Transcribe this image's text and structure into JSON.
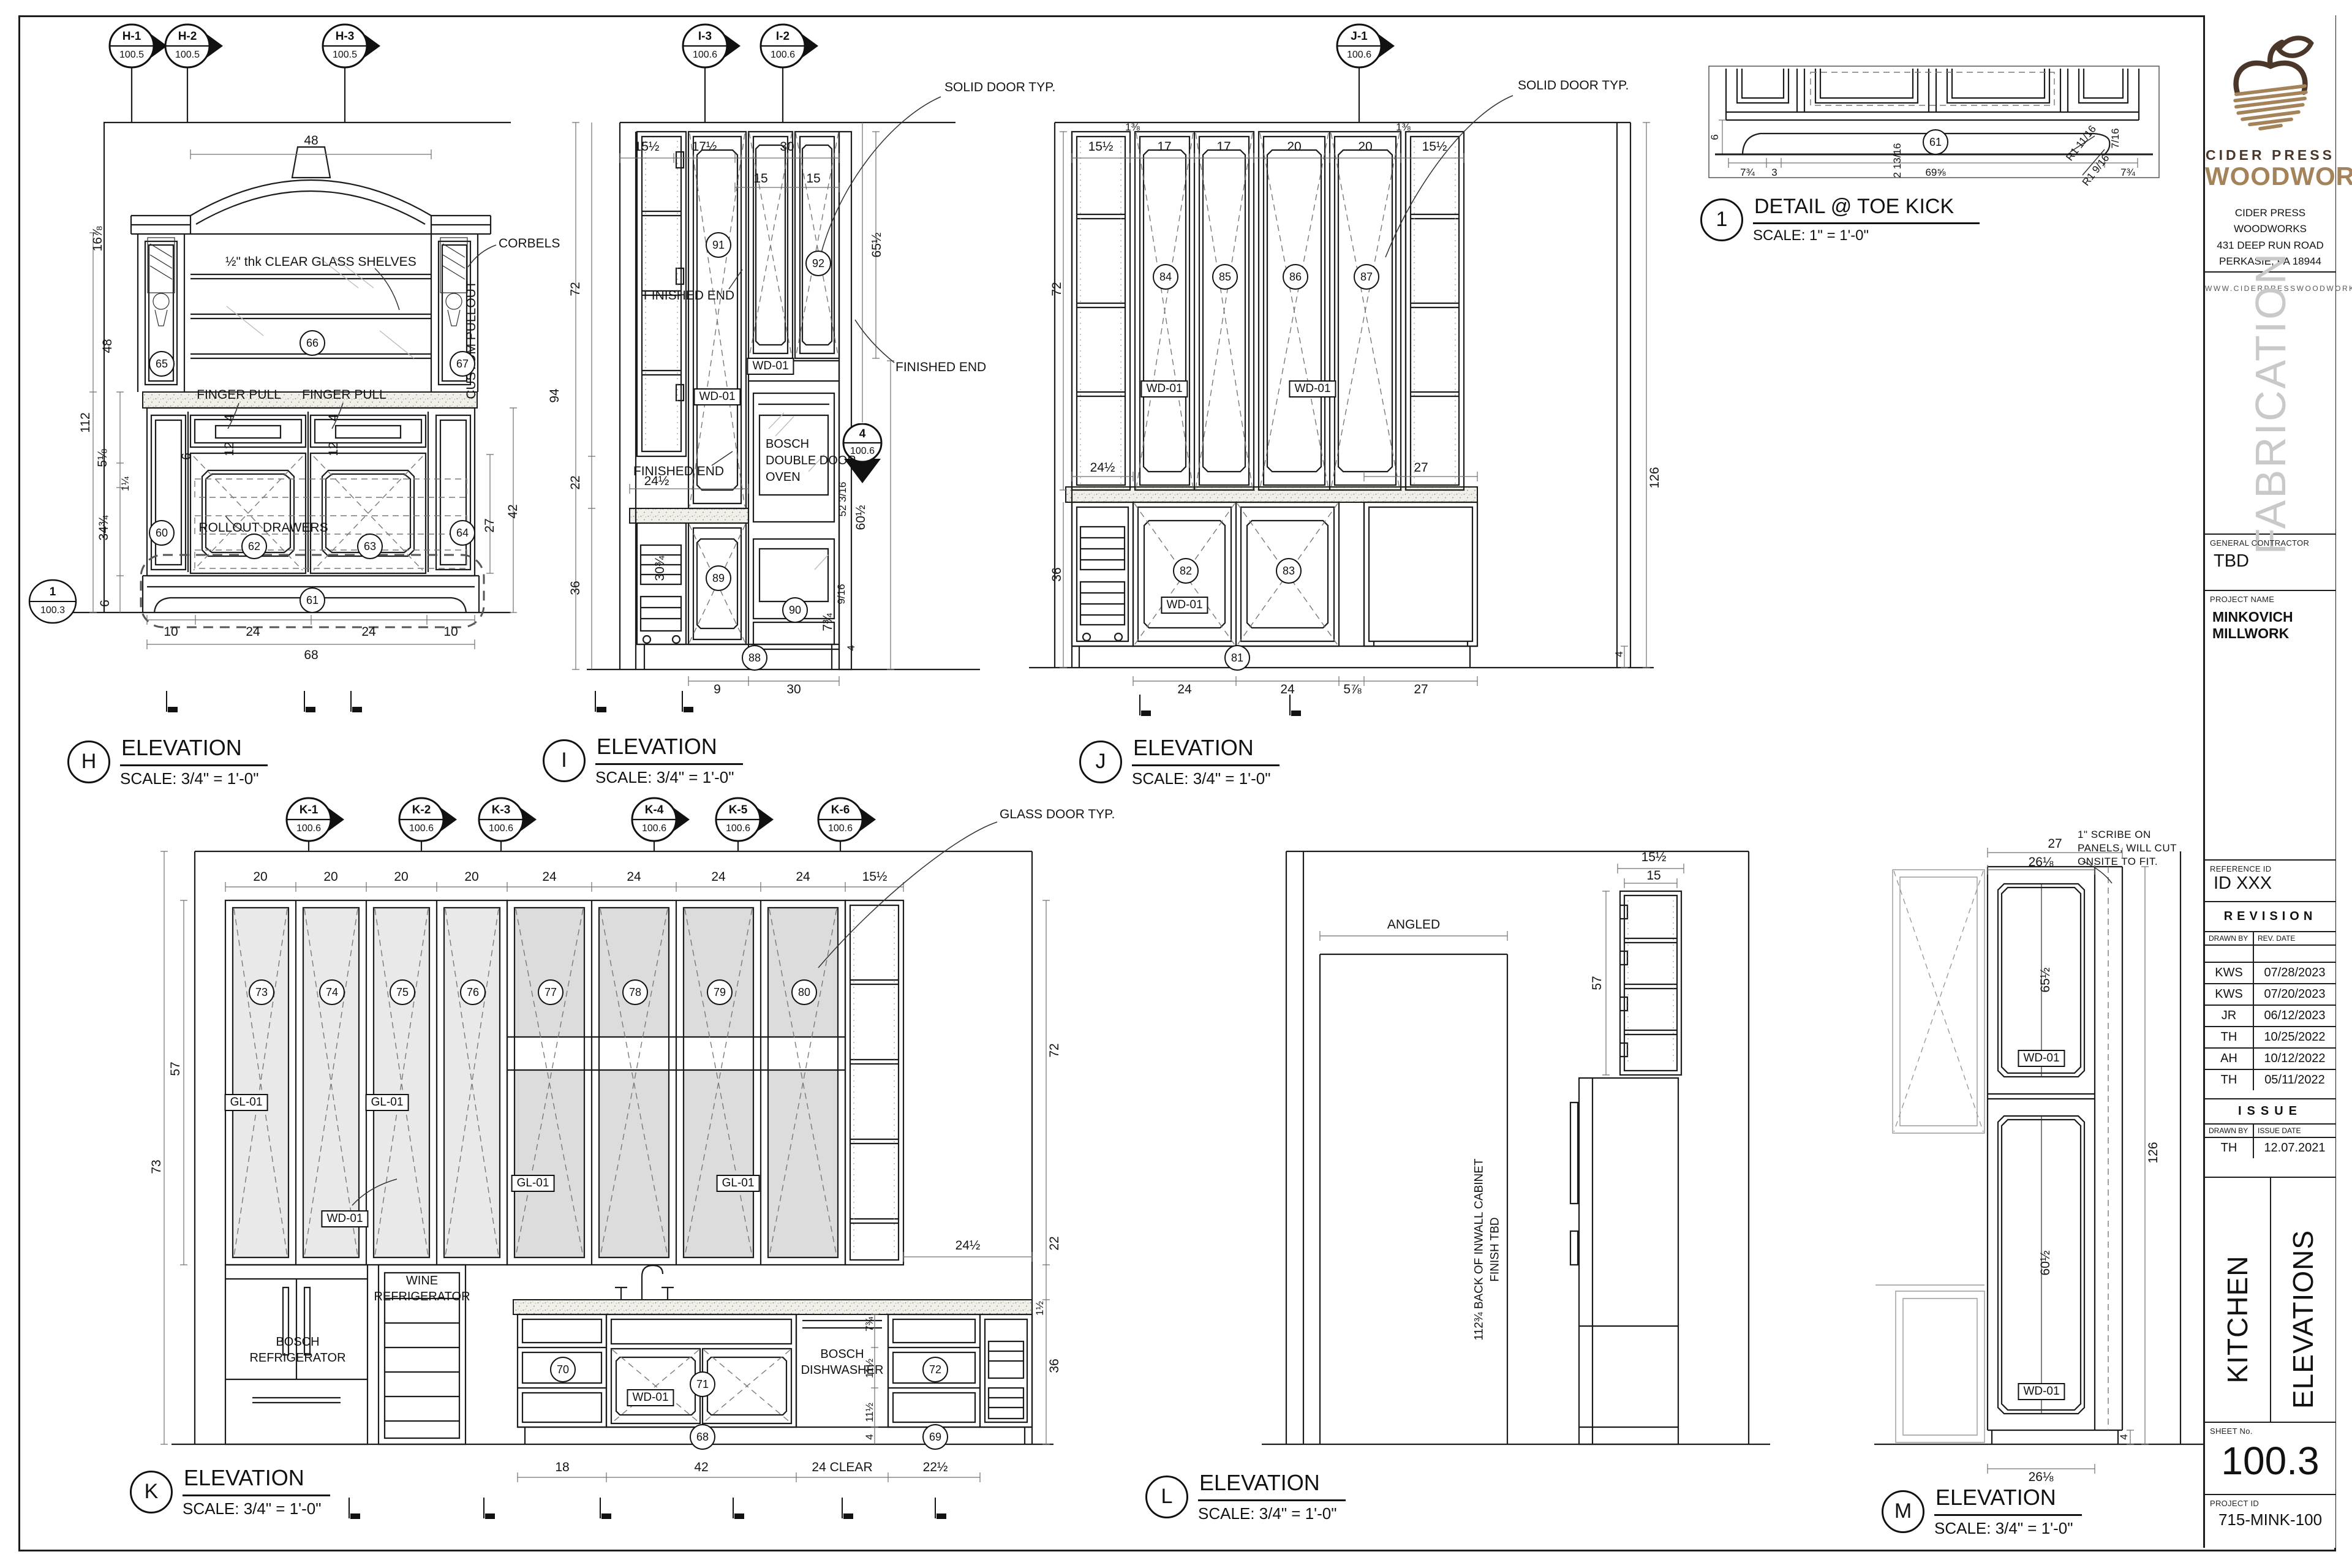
{
  "title_block": {
    "brand_line1": "CIDER PRESS",
    "brand_line2": "WOODWORKS",
    "address1": "CIDER PRESS WOODWORKS",
    "address2": "431 DEEP RUN ROAD",
    "address3": "PERKASIE, PA 18944",
    "website": "WWW.CIDERPRESSWOODWORKS.COM",
    "watermark": "FABRICATION",
    "gc_label": "GENERAL CONTRACTOR",
    "gc": "TBD",
    "pn_label": "PROJECT NAME",
    "pn": "MINKOVICH MILLWORK",
    "ref_label": "REFERENCE ID",
    "ref": "ID XXX",
    "revision_title": "REVISION",
    "col_drawn": "DRAWN BY",
    "col_revdate": "REV. DATE",
    "revisions": [
      {
        "by": "KWS",
        "date": "07/28/2023"
      },
      {
        "by": "KWS",
        "date": "07/20/2023"
      },
      {
        "by": "JR",
        "date": "06/12/2023"
      },
      {
        "by": "TH",
        "date": "10/25/2022"
      },
      {
        "by": "AH",
        "date": "10/12/2022"
      },
      {
        "by": "TH",
        "date": "05/11/2022"
      }
    ],
    "issue_title": "ISSUE",
    "col_issuedate": "ISSUE DATE",
    "issue_by": "TH",
    "issue_date": "12.07.2021",
    "name1": "KITCHEN",
    "name2": "ELEVATIONS",
    "sheetno_label": "SHEET No.",
    "sheetno": "100.3",
    "pid_label": "PROJECT ID",
    "pid": "715-MINK-100"
  },
  "detail": {
    "num": "1",
    "title": "DETAIL  @ TOE KICK",
    "scale": "SCALE: 1\" = 1'-0\"",
    "bubble": "61",
    "d6": "6",
    "d7a": "7¾",
    "d3": "3",
    "d213": "2 13/16",
    "d69": "69⅝",
    "r1": "R1 11/16",
    "r2": "R1 9/16",
    "d716": "7/16",
    "d7b": "7¾"
  },
  "elev_h": {
    "letter": "H",
    "title": "ELEVATION",
    "scale": "SCALE: 3/4\" = 1'-0\"",
    "markers": [
      {
        "id": "H-1",
        "sh": "100.5"
      },
      {
        "id": "H-2",
        "sh": "100.5"
      },
      {
        "id": "H-3",
        "sh": "100.5"
      }
    ],
    "ref_top": "1",
    "ref_bot": "100.3",
    "corbels": "CORBELS",
    "shelves": "½\" thk CLEAR GLASS SHELVES",
    "fp1": "FINGER PULL",
    "fp2": "FINGER PULL",
    "rollout": "ROLLOUT DRAWERS",
    "pullout": "CUSTOM PULLOUT",
    "c65": "65",
    "c66": "66",
    "c67": "67",
    "c60": "60",
    "c62": "62",
    "c63": "63",
    "c64": "64",
    "c61": "61",
    "arch": "48",
    "L0": "16⅞",
    "L1": "48",
    "L2": "112",
    "L3": "5⅛",
    "L4": "1¼",
    "L5": "34¾",
    "L6": "6",
    "fp4a": "4",
    "fp4b": "4",
    "d12a": "12",
    "d12b": "12",
    "d6i": "6",
    "d27": "27",
    "d42": "42",
    "B0": "10",
    "B1": "24",
    "B2": "24",
    "B3": "10",
    "total": "68"
  },
  "elev_i": {
    "letter": "I",
    "title": "ELEVATION",
    "scale": "SCALE: 3/4\" = 1'-0\"",
    "markers": [
      {
        "id": "I-3",
        "sh": "100.6"
      },
      {
        "id": "I-2",
        "sh": "100.6"
      }
    ],
    "sm_top": "4",
    "sm_bot": "100.6",
    "solid": "SOLID DOOR TYP.",
    "fe1": "FINISHED END",
    "fe2": "FINISHED END",
    "fe3": "FINISHED END",
    "oven1": "BOSCH",
    "oven2": "DOUBLE DOOR",
    "oven3": "OVEN",
    "tag1": "WD-01",
    "tag2": "WD-01",
    "c91": "91",
    "c92": "92",
    "c89": "89",
    "c90": "90",
    "c88": "88",
    "T0": "15½",
    "T1": "17½",
    "T2": "30",
    "T3": "15",
    "T4": "15",
    "L0": "94",
    "L1": "72",
    "L2": "22",
    "L3": "36",
    "R0": "65½",
    "R1": "52 3/16",
    "R2": "60½",
    "R3": "9/16",
    "R4": "7¾",
    "R5": "4",
    "mid": "24½",
    "rot": "30¾",
    "B0": "9",
    "B1": "30"
  },
  "elev_j": {
    "letter": "J",
    "title": "ELEVATION",
    "scale": "SCALE: 3/4\" = 1'-0\"",
    "markers": [
      {
        "id": "J-1",
        "sh": "100.6"
      }
    ],
    "solid": "SOLID DOOR TYP.",
    "tag1": "WD-01",
    "tag2": "WD-01",
    "tag3": "WD-01",
    "c84": "84",
    "c85": "85",
    "c86": "86",
    "c87": "87",
    "c82": "82",
    "c83": "83",
    "c81": "81",
    "T0": "15½",
    "T1": "1⅜",
    "T2": "17",
    "T3": "17",
    "T4": "20",
    "T5": "20",
    "T6": "1⅜",
    "T7": "15½",
    "L0": "72",
    "L1": "36",
    "R0": "27",
    "R1": "4",
    "R2": "126",
    "mid": "24½",
    "B0": "24",
    "B1": "24",
    "B2": "5⅞",
    "B3": "27"
  },
  "elev_k": {
    "letter": "K",
    "title": "ELEVATION",
    "scale": "SCALE: 3/4\" = 1'-0\"",
    "markers": [
      {
        "id": "K-1",
        "sh": "100.6"
      },
      {
        "id": "K-2",
        "sh": "100.6"
      },
      {
        "id": "K-3",
        "sh": "100.6"
      },
      {
        "id": "K-4",
        "sh": "100.6"
      },
      {
        "id": "K-5",
        "sh": "100.6"
      },
      {
        "id": "K-6",
        "sh": "100.6"
      }
    ],
    "glass": "GLASS DOOR TYP.",
    "wine1": "WINE",
    "wine2": "REFRIGERATOR",
    "fr1": "BOSCH",
    "fr2": "REFRIGERATOR",
    "dw1": "BOSCH",
    "dw2": "DISHWASHER",
    "gl1": "GL-01",
    "gl2": "GL-01",
    "gl3": "GL-01",
    "gl4": "GL-01",
    "wd1": "WD-01",
    "wd2": "WD-01",
    "c73": "73",
    "c74": "74",
    "c75": "75",
    "c76": "76",
    "c77": "77",
    "c78": "78",
    "c79": "79",
    "c80": "80",
    "c70": "70",
    "c71": "71",
    "c72": "72",
    "c68": "68",
    "c69": "69",
    "T0": "20",
    "T1": "20",
    "T2": "20",
    "T3": "20",
    "T4": "24",
    "T5": "24",
    "T6": "24",
    "T7": "24",
    "T8": "15½",
    "L0": "57",
    "L1": "73",
    "R0": "72",
    "R1": "22",
    "R2": "36",
    "R3": "24½",
    "R4": "7¾",
    "R5": "11½",
    "R6": "11½",
    "R7": "4",
    "R8": "1½",
    "B0": "18",
    "B1": "42",
    "B2": "24 CLEAR",
    "B3": "22½"
  },
  "elev_l": {
    "letter": "L",
    "title": "ELEVATION",
    "scale": "SCALE: 3/4\" = 1'-0\"",
    "angled": "ANGLED",
    "inwall1": "112¾ BACK OF INWALL CABINET",
    "inwall2": "FINISH TBD",
    "T0": "15½",
    "T1": "15",
    "L0": "57"
  },
  "elev_m": {
    "letter": "M",
    "title": "ELEVATION",
    "scale": "SCALE: 3/4\" = 1'-0\"",
    "note1": "1\" SCRIBE ON",
    "note2": "PANELS, WILL CUT",
    "note3": "ONSITE TO FIT.",
    "tag1": "WD-01",
    "tag2": "WD-01",
    "T0": "27",
    "T1": "26⅛",
    "P0": "65½",
    "P1": "60½",
    "R0": "126",
    "R1": "4",
    "B0": "26⅛"
  }
}
